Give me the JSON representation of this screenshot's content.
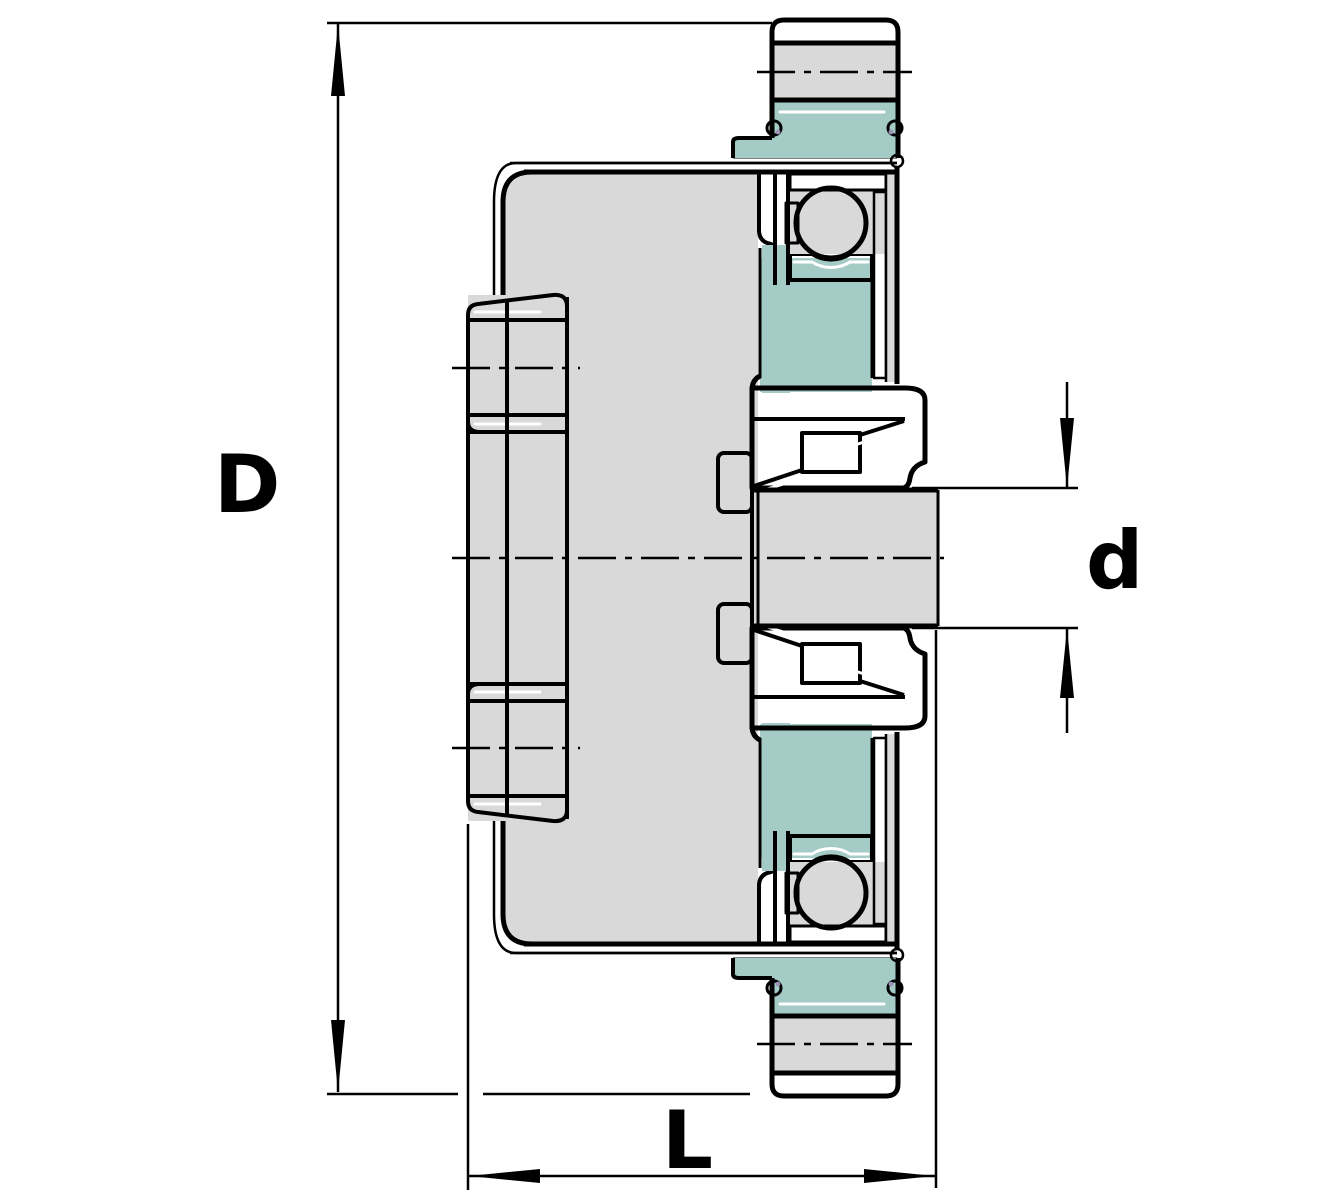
{
  "drawing": {
    "title": "Flanged bearing unit cross-section",
    "type": "engineering-section-drawing",
    "dimensions": {
      "outer": {
        "label": "D",
        "meaning": "flange outside dimension"
      },
      "bore": {
        "label": "d",
        "meaning": "shaft / bore diameter"
      },
      "length": {
        "label": "L",
        "meaning": "total unit length"
      }
    }
  },
  "colors": {
    "line": "#000000",
    "housing-gray": "#d9d9d9",
    "bearing-teal": "#a5cbc7",
    "light-teal": "#cfe4e1",
    "cage-pink": "#d9bfc3",
    "oring-purple": "#9d92b5",
    "background": "#ffffff"
  }
}
